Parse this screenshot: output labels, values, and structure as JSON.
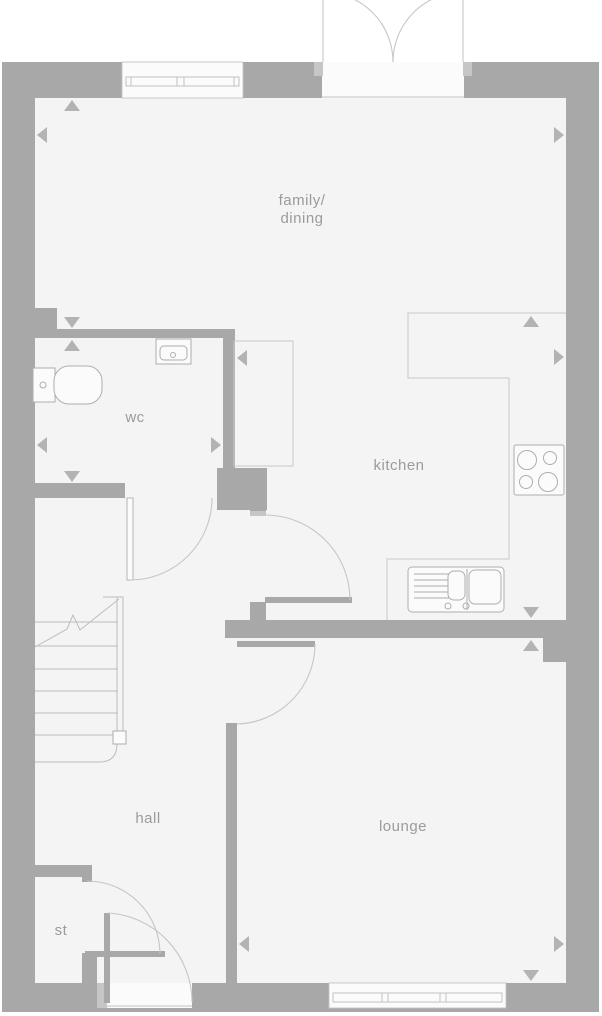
{
  "plan": {
    "type": "floor-plan",
    "rooms": [
      {
        "name": "family-dining",
        "label_line1": "family/",
        "label_line2": "dining"
      },
      {
        "name": "wc",
        "label": "wc"
      },
      {
        "name": "kitchen",
        "label": "kitchen"
      },
      {
        "name": "hall",
        "label": "hall"
      },
      {
        "name": "lounge",
        "label": "lounge"
      },
      {
        "name": "store",
        "label": "st"
      }
    ],
    "doors": [
      {
        "name": "french-doors",
        "type": "double",
        "location": "family-dining-top"
      },
      {
        "name": "front-door",
        "location": "hall-bottom"
      },
      {
        "name": "wc-door",
        "location": "wc-to-hall"
      },
      {
        "name": "kitchen-door",
        "location": "hall-to-kitchen"
      },
      {
        "name": "lounge-door",
        "location": "hall-to-lounge"
      },
      {
        "name": "store-door",
        "location": "store-to-hall"
      }
    ],
    "windows": [
      {
        "name": "family-dining-window",
        "panes": 2,
        "location": "top-wall"
      },
      {
        "name": "lounge-window",
        "panes": 3,
        "location": "bottom-wall"
      }
    ],
    "fixtures": [
      {
        "name": "toilet",
        "room": "wc"
      },
      {
        "name": "wash-basin",
        "room": "wc"
      },
      {
        "name": "hob",
        "room": "kitchen"
      },
      {
        "name": "kitchen-sink",
        "room": "kitchen"
      },
      {
        "name": "worktop",
        "room": "kitchen"
      },
      {
        "name": "stairs",
        "room": "hall"
      },
      {
        "name": "cupboard",
        "room": "kitchen"
      }
    ],
    "dimension_markers": {
      "count": 16,
      "style": "small-gray-triangles"
    }
  },
  "palette": {
    "page_bg": "#ffffff",
    "wall": "#a8a8a8",
    "floor": "#f4f4f5",
    "window_fill": "#fbfbfb",
    "frame": "#c2c2c2",
    "outline": "#c9c9c9",
    "arc": "#c6c6c6",
    "fixture_fill": "#fbfbfb",
    "fixture_stroke": "#aeaeae",
    "jamb": "#c6c6c6",
    "stair": "#bdbdbd",
    "marker": "#b3b3b3",
    "label": "#9b9b9b"
  }
}
